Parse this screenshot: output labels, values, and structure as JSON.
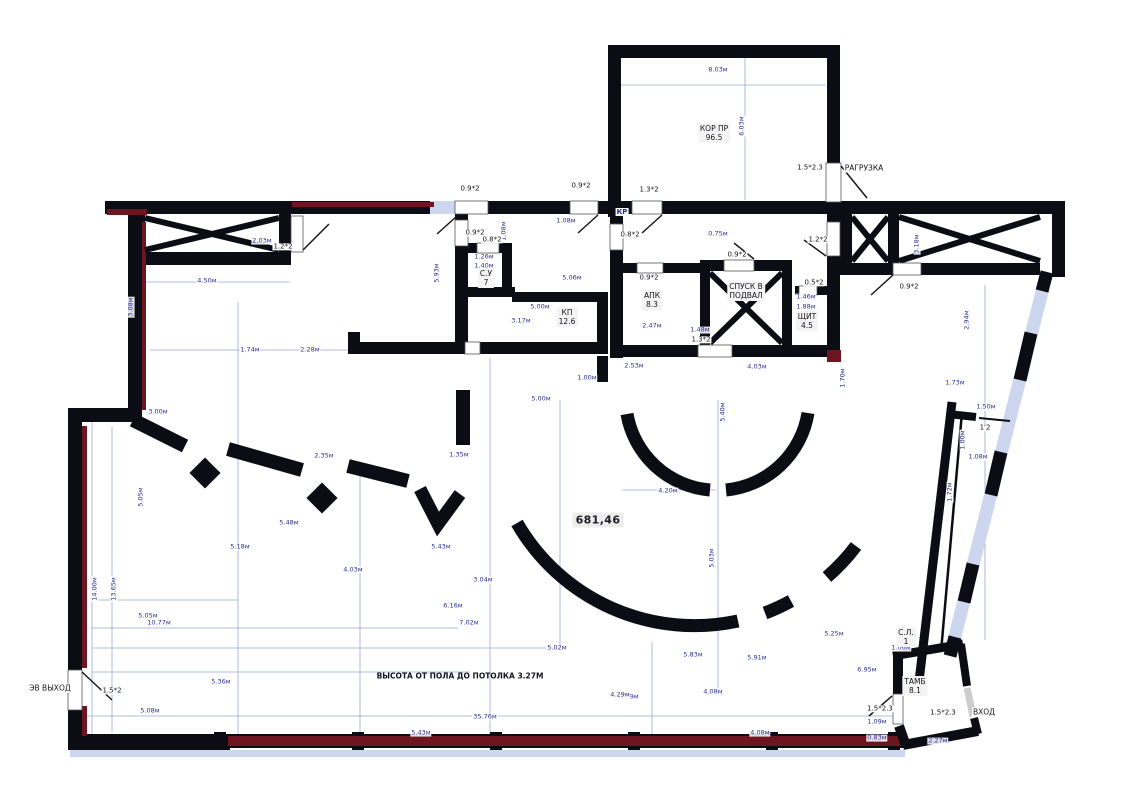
{
  "colors": {
    "wall": "#0c0c15",
    "dim_blue": "#2b2f92",
    "accent_maroon": "#6d1520",
    "glazing": "#cdd6ef",
    "label_bg": "#f2f2f2"
  },
  "plan": {
    "area_label": {
      "t": "681,46",
      "x": 598,
      "y": 520
    },
    "note": {
      "t": "ВЫСОТА ОТ ПОЛА ДО ПОТОЛКА 3.27М",
      "x": 460,
      "y": 676
    },
    "rooms": [
      {
        "l1": "КОР ПР",
        "l2": "96.5",
        "x": 714,
        "y": 133
      },
      {
        "l1": "АПК",
        "l2": "8.3",
        "x": 652,
        "y": 300
      },
      {
        "l1": "СПУСК В",
        "l2": "ПОДВАЛ",
        "x": 746,
        "y": 291
      },
      {
        "l1": "ЩИТ",
        "l2": "4.5",
        "x": 807,
        "y": 321
      },
      {
        "l1": "КП",
        "l2": "12.6",
        "x": 567,
        "y": 317
      },
      {
        "l1": "С.У",
        "l2": "7",
        "x": 486,
        "y": 278
      },
      {
        "l1": "ТАМБ",
        "l2": "8.1",
        "x": 915,
        "y": 686
      },
      {
        "l1": "С.Л.",
        "l2": "1",
        "x": 906,
        "y": 637
      }
    ],
    "annotations": [
      {
        "t": "РАГРУЗКА",
        "x": 864,
        "y": 168
      },
      {
        "t": "ВХОД",
        "x": 984,
        "y": 712
      },
      {
        "t": "ЭВ ВЫХОД",
        "x": 50,
        "y": 688
      },
      {
        "t": "КР",
        "x": 622,
        "y": 212,
        "accent": 1
      }
    ],
    "door_labels": [
      {
        "t": "1.2*2",
        "x": 283,
        "y": 247
      },
      {
        "t": "0.9*2",
        "x": 470,
        "y": 189
      },
      {
        "t": "0.9*2",
        "x": 475,
        "y": 233
      },
      {
        "t": "0.8*2",
        "x": 492,
        "y": 240
      },
      {
        "t": "0.9*2",
        "x": 581,
        "y": 186
      },
      {
        "t": "1.3*2",
        "x": 649,
        "y": 190
      },
      {
        "t": "0.8*2",
        "x": 630,
        "y": 235
      },
      {
        "t": "0.9*2",
        "x": 649,
        "y": 278
      },
      {
        "t": "0.9*2",
        "x": 737,
        "y": 255
      },
      {
        "t": "0.5*2",
        "x": 814,
        "y": 283
      },
      {
        "t": "1.3*2",
        "x": 701,
        "y": 340
      },
      {
        "t": "1.2*2",
        "x": 818,
        "y": 240
      },
      {
        "t": "0.9*2",
        "x": 909,
        "y": 287
      },
      {
        "t": "1.5*2.3",
        "x": 810,
        "y": 168
      },
      {
        "t": "1.5*2",
        "x": 112,
        "y": 691
      },
      {
        "t": "1.5*2.3",
        "x": 880,
        "y": 709
      },
      {
        "t": "1.5*2.3",
        "x": 943,
        "y": 713
      },
      {
        "t": "1'2",
        "x": 985,
        "y": 428
      }
    ],
    "dims": [
      {
        "t": "8.03м",
        "x": 718,
        "y": 70
      },
      {
        "t": "6.03м",
        "x": 742,
        "y": 126,
        "r": 1
      },
      {
        "t": "2.03м",
        "x": 262,
        "y": 241
      },
      {
        "t": "4.50м",
        "x": 207,
        "y": 281
      },
      {
        "t": "3.18м",
        "x": 917,
        "y": 244,
        "r": 1
      },
      {
        "t": "2.94м",
        "x": 967,
        "y": 320,
        "r": 1
      },
      {
        "t": "5.93м",
        "x": 437,
        "y": 273,
        "r": 1
      },
      {
        "t": "1.08м",
        "x": 504,
        "y": 231,
        "r": 1
      },
      {
        "t": "1.08м",
        "x": 566,
        "y": 221
      },
      {
        "t": "0.75м",
        "x": 718,
        "y": 234
      },
      {
        "t": "1.26м",
        "x": 484,
        "y": 257
      },
      {
        "t": "1.40м",
        "x": 484,
        "y": 266
      },
      {
        "t": "5.06м",
        "x": 572,
        "y": 278
      },
      {
        "t": "5.00м",
        "x": 540,
        "y": 307
      },
      {
        "t": "3.17м",
        "x": 521,
        "y": 321
      },
      {
        "t": "2.47м",
        "x": 652,
        "y": 326
      },
      {
        "t": "1.48м",
        "x": 700,
        "y": 330
      },
      {
        "t": "2.53м",
        "x": 634,
        "y": 366
      },
      {
        "t": "4.03м",
        "x": 757,
        "y": 367
      },
      {
        "t": "1.46м",
        "x": 806,
        "y": 297
      },
      {
        "t": "1.88м",
        "x": 806,
        "y": 307
      },
      {
        "t": "1.70м",
        "x": 843,
        "y": 378,
        "r": 1
      },
      {
        "t": "3.08м",
        "x": 131,
        "y": 307,
        "r": 1
      },
      {
        "t": "1.74м",
        "x": 250,
        "y": 350
      },
      {
        "t": "2.28м",
        "x": 310,
        "y": 350
      },
      {
        "t": "3.00м",
        "x": 158,
        "y": 412
      },
      {
        "t": "2.35м",
        "x": 324,
        "y": 456
      },
      {
        "t": "1.35м",
        "x": 459,
        "y": 455
      },
      {
        "t": "5.05м",
        "x": 141,
        "y": 497,
        "r": 1
      },
      {
        "t": "1.73м",
        "x": 955,
        "y": 383
      },
      {
        "t": "1.50м",
        "x": 986,
        "y": 407
      },
      {
        "t": "1.00м",
        "x": 963,
        "y": 440,
        "r": 1
      },
      {
        "t": "1.08м",
        "x": 978,
        "y": 457
      },
      {
        "t": "1.72м",
        "x": 950,
        "y": 492,
        "r": 1
      },
      {
        "t": "4.20м",
        "x": 668,
        "y": 491
      },
      {
        "t": "5.40м",
        "x": 723,
        "y": 412,
        "r": 1
      },
      {
        "t": "5.03м",
        "x": 712,
        "y": 558,
        "r": 1
      },
      {
        "t": "1.00м",
        "x": 587,
        "y": 378
      },
      {
        "t": "5.00м",
        "x": 541,
        "y": 399
      },
      {
        "t": "5.18м",
        "x": 240,
        "y": 547
      },
      {
        "t": "5.48м",
        "x": 289,
        "y": 523
      },
      {
        "t": "4.03м",
        "x": 353,
        "y": 570
      },
      {
        "t": "5.43м",
        "x": 441,
        "y": 547
      },
      {
        "t": "3.04м",
        "x": 483,
        "y": 580
      },
      {
        "t": "6.16м",
        "x": 453,
        "y": 606
      },
      {
        "t": "7.02м",
        "x": 469,
        "y": 623
      },
      {
        "t": "5.36м",
        "x": 221,
        "y": 682
      },
      {
        "t": "5.08м",
        "x": 150,
        "y": 711
      },
      {
        "t": "14.00м",
        "x": 95,
        "y": 589,
        "r": 1
      },
      {
        "t": "13.65м",
        "x": 114,
        "y": 589,
        "r": 1
      },
      {
        "t": "5.05м",
        "x": 148,
        "y": 616
      },
      {
        "t": "10.77м",
        "x": 159,
        "y": 623
      },
      {
        "t": "5.02м",
        "x": 557,
        "y": 648
      },
      {
        "t": "5.83м",
        "x": 693,
        "y": 655
      },
      {
        "t": "4.79м",
        "x": 629,
        "y": 697
      },
      {
        "t": "4.08м",
        "x": 713,
        "y": 692
      },
      {
        "t": "5.91м",
        "x": 757,
        "y": 658
      },
      {
        "t": "5.25м",
        "x": 834,
        "y": 634
      },
      {
        "t": "6.95м",
        "x": 867,
        "y": 670
      },
      {
        "t": "1.06м",
        "x": 901,
        "y": 648
      },
      {
        "t": "1.09м",
        "x": 877,
        "y": 722
      },
      {
        "t": "0.83м",
        "x": 877,
        "y": 738
      },
      {
        "t": "2.27м",
        "x": 938,
        "y": 741
      },
      {
        "t": "4.29м",
        "x": 620,
        "y": 695
      },
      {
        "t": "35.76м",
        "x": 485,
        "y": 717
      },
      {
        "t": "5.43м",
        "x": 421,
        "y": 733
      },
      {
        "t": "4.08м",
        "x": 760,
        "y": 733
      }
    ]
  }
}
